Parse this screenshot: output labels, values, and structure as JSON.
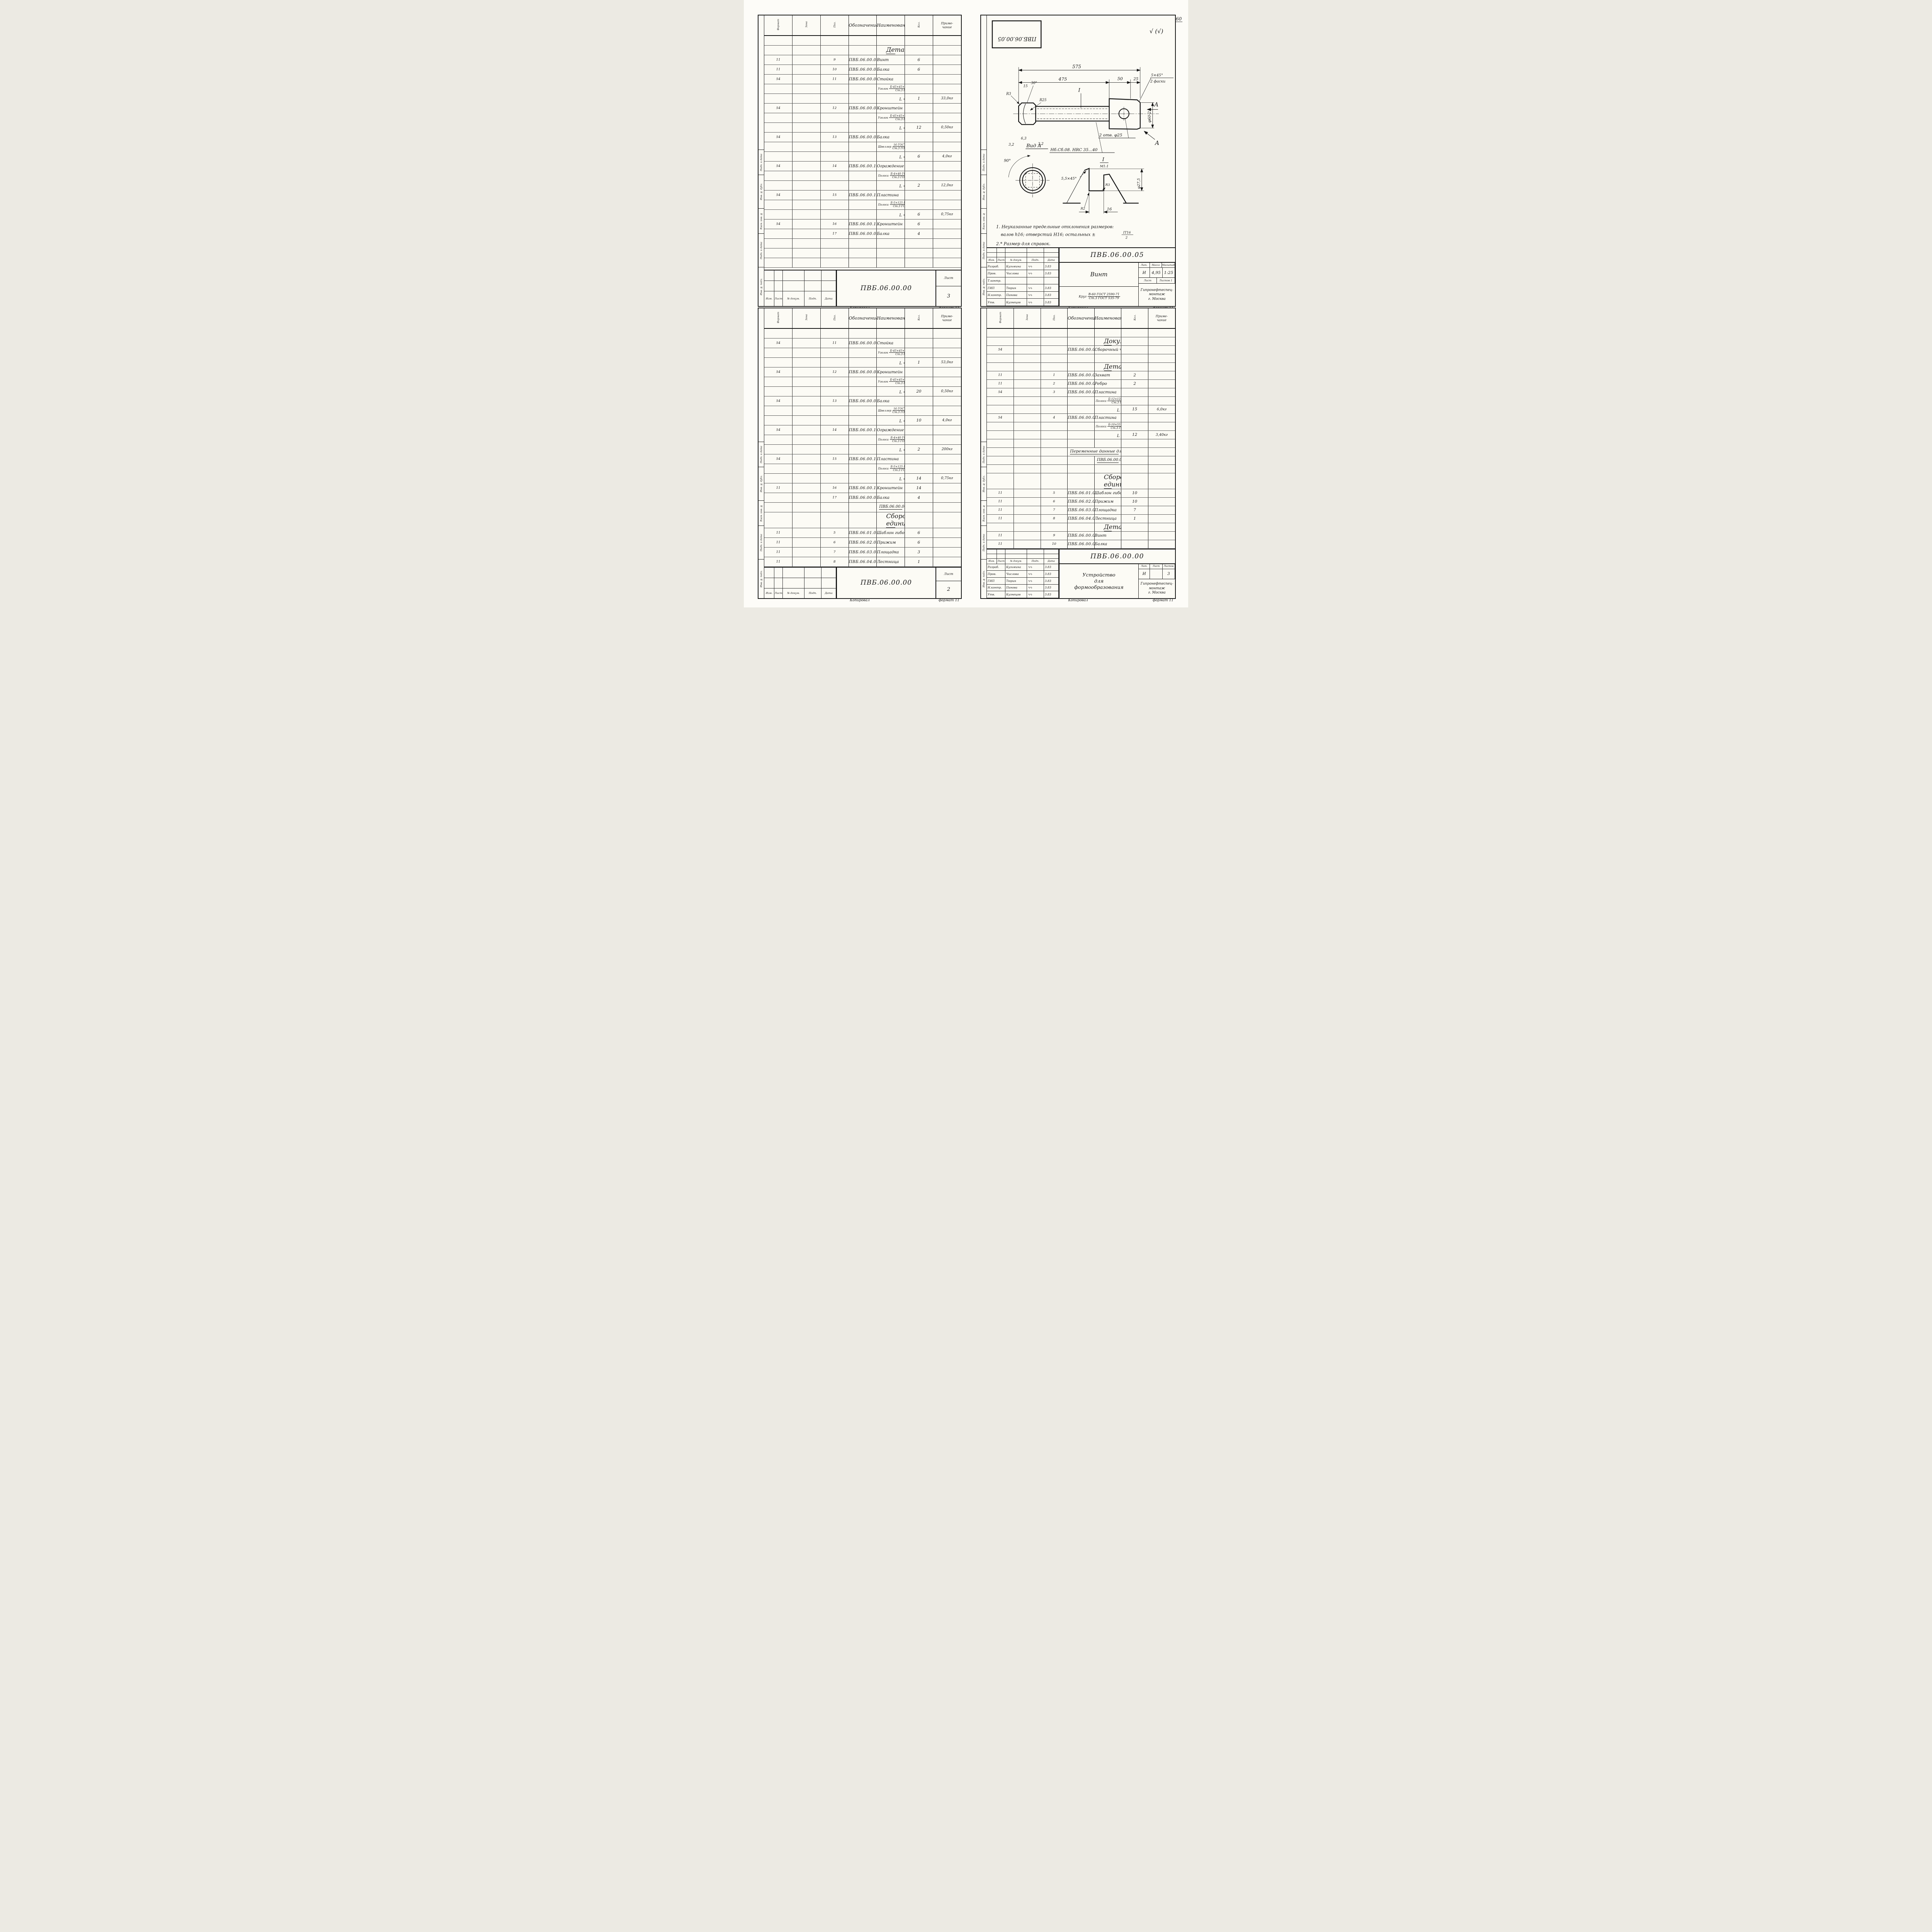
{
  "page": {
    "number": "60",
    "handwritten_margin_note": "т.пр 704-1-172.84 а.7",
    "copy_label": "Копировал",
    "format_label": "формат 11"
  },
  "spec_columns": {
    "format": "Формат",
    "zone": "Зона",
    "pos": "Поз.",
    "designation": "Обозначение",
    "name": "Наименование",
    "qty": "Кол.",
    "note1": "Приме-",
    "note2": "чание"
  },
  "margin_stamps": [
    "Подп. и дата",
    "Инв. № дубл.",
    "Взам. инв. №",
    "Подп. и дата",
    "Инв. № подл."
  ],
  "rev_labels": [
    "Изм.",
    "Лист",
    "№ докум.",
    "Подп.",
    "Дата"
  ],
  "org_lines": [
    "Гипронефтеспец-",
    "монтаж",
    "г. Москва"
  ],
  "signature_glyph": "∿∿",
  "tb_labels": {
    "lit": "Лит.",
    "mass": "Масса",
    "scale": "Масштаб",
    "sheet": "Лист",
    "sheets": "Листов"
  },
  "staff_spec": [
    {
      "role": "Разраб.",
      "name": "Кузьмина",
      "date": "3.83"
    },
    {
      "role": "Пров.",
      "name": "Числова",
      "date": "3.83"
    },
    {
      "role": "ГИП",
      "name": "Тюрин",
      "date": "3.83"
    },
    {
      "role": "Н.контр.",
      "name": "Панова",
      "date": "3.83"
    },
    {
      "role": "Утв.",
      "name": "Кузнецов",
      "date": "3.83"
    }
  ],
  "staff_drawing": [
    {
      "role": "Разраб.",
      "name": "Кузьмина",
      "date": "3.83"
    },
    {
      "role": "Пров.",
      "name": "Числова",
      "date": "3.83"
    },
    {
      "role": "Т.контр.",
      "name": "",
      "date": ""
    },
    {
      "role": "ГИП",
      "name": "Тюрин",
      "date": "3.83"
    },
    {
      "role": "Н.контр.",
      "name": "Панова",
      "date": "3.83"
    },
    {
      "role": "Утв.",
      "name": "Кузнецов",
      "date": "3.83"
    }
  ],
  "sheets": {
    "spec3": {
      "rows": [
        {
          "t": "b"
        },
        {
          "t": "s",
          "n": "Детали"
        },
        {
          "t": "i",
          "f": "11",
          "p": "9",
          "d": "ПВБ.06.00.05",
          "n": "Винт",
          "k": "6"
        },
        {
          "t": "i",
          "f": "11",
          "p": "10",
          "d": "ПВБ.06.00.06",
          "n": "Балка",
          "k": "6"
        },
        {
          "t": "i",
          "f": "54",
          "p": "11",
          "d": "ПВБ.06.00.07-01",
          "n": "Стойка"
        },
        {
          "t": "m",
          "a": "Уголок",
          "bb": "Б-45×45×5 ГОСТ 8509-72",
          "c": "Ст.3 ГОСТ 535-79"
        },
        {
          "t": "l",
          "n": "L = 9720",
          "k": "1",
          "m": "33,0кг"
        },
        {
          "t": "i",
          "f": "54",
          "p": "12",
          "d": "ПВБ.06.00.08",
          "n": "Кронштейн"
        },
        {
          "t": "m",
          "a": "Уголок",
          "bb": "Б-45×45×5 ГОСТ 8509-72",
          "c": "Ст.3 ГОСТ 535-79"
        },
        {
          "t": "l",
          "n": "L = 150",
          "k": "12",
          "m": "0,50кг"
        },
        {
          "t": "i",
          "f": "54",
          "p": "13",
          "d": "ПВБ.06.00.09",
          "n": "Балка"
        },
        {
          "t": "m",
          "a": "Швеллер",
          "bb": "16 ГОСТ 8240-72",
          "c": "Ст.3 ГОСТ 535-79"
        },
        {
          "t": "l",
          "n": "L = 280",
          "k": "6",
          "m": "4,0кг"
        },
        {
          "t": "i",
          "f": "54",
          "p": "14",
          "d": "ПВБ.06.00.10-01",
          "n": "Ограждение"
        },
        {
          "t": "m",
          "a": "Полоса",
          "bb": "Б-4×40 ГОСТ 103-76",
          "c": "Ст.3 ГОСТ 535-79"
        },
        {
          "t": "l",
          "n": "L = 9670",
          "k": "2",
          "m": "12,0кг"
        },
        {
          "t": "i",
          "f": "54",
          "p": "15",
          "d": "ПВБ.06.00.11",
          "n": "Пластина"
        },
        {
          "t": "m",
          "a": "Полоса",
          "bb": "Б-5×125 ГОСТ 103-76",
          "c": "Ст.3 ГОСТ 535-79"
        },
        {
          "t": "l",
          "n": "L = 150",
          "k": "6",
          "m": "0,75кг"
        },
        {
          "t": "i",
          "f": "54",
          "p": "16",
          "d": "ПВБ.06.00.12",
          "n": "Кронштейн",
          "k": "6"
        },
        {
          "t": "i",
          "f": "",
          "p": "17",
          "d": "ПВБ.06.00.06-01",
          "n": "Балка",
          "k": "4"
        },
        {
          "t": "b"
        },
        {
          "t": "b"
        },
        {
          "t": "b"
        }
      ],
      "footer": {
        "doc": "ПВБ.06.00.00",
        "sheet_label": "Лист",
        "sheet_no": "3"
      }
    },
    "spec2": {
      "rows": [
        {
          "t": "b"
        },
        {
          "t": "i",
          "f": "54",
          "p": "11",
          "d": "ПВБ.06.00.07",
          "n": "Стойка"
        },
        {
          "t": "m",
          "a": "Уголок",
          "bb": "Б-45×45×5 ГОСТ 8509-72",
          "c": "Ст.3 ГОСТ 535-79"
        },
        {
          "t": "l",
          "n": "L = 15120",
          "k": "1",
          "m": "53,0кг"
        },
        {
          "t": "i",
          "f": "54",
          "p": "12",
          "d": "ПВБ.06.00.08",
          "n": "Кронштейн"
        },
        {
          "t": "m",
          "a": "Уголок",
          "bb": "Б-45×45×5 ГОСТ 8509-72",
          "c": "Ст.3 ГОСТ 535-79"
        },
        {
          "t": "l",
          "n": "L = 150",
          "k": "20",
          "m": "0,50кг"
        },
        {
          "t": "i",
          "f": "54",
          "p": "13",
          "d": "ПВБ.06.00.09",
          "n": "Балка"
        },
        {
          "t": "m",
          "a": "Швеллер",
          "bb": "16 ГОСТ 8240-72",
          "c": "Ст.3 ГОСТ 535-79"
        },
        {
          "t": "l",
          "n": "L = 280",
          "k": "10",
          "m": "4,0кг"
        },
        {
          "t": "i",
          "f": "54",
          "p": "14",
          "d": "ПВБ.06.00.10",
          "n": "Ограждение"
        },
        {
          "t": "m",
          "a": "Полоса",
          "bb": "Б-4×40 ГОСТ 103-76",
          "c": "Ст.3 ГОСТ 535-79"
        },
        {
          "t": "l",
          "n": "L = 15670",
          "k": "2",
          "m": "200кг"
        },
        {
          "t": "i",
          "f": "54",
          "p": "15",
          "d": "ПВБ.06.00.11",
          "n": "Пластина"
        },
        {
          "t": "m",
          "a": "Полоса",
          "bb": "Б-5×125 ГОСТ 103-76",
          "c": "Ст.3 ГОСТ 535-79"
        },
        {
          "t": "l",
          "n": "L = 150",
          "k": "14",
          "m": "0,75кг"
        },
        {
          "t": "i",
          "f": "11",
          "p": "16",
          "d": "ПВБ.06.00.12",
          "n": "Кронштейн",
          "k": "14"
        },
        {
          "t": "i",
          "f": "",
          "p": "17",
          "d": "ПВБ.06.00.06-01",
          "n": "Балка",
          "k": "4"
        },
        {
          "t": "t1",
          "n": "ПВБ.06.00.00-01 см.Сб"
        },
        {
          "t": "s",
          "n": "Сборочные единицы"
        },
        {
          "t": "i",
          "f": "11",
          "p": "5",
          "d": "ПВБ.06.01.00",
          "n": "Шаблон гибочный",
          "k": "6"
        },
        {
          "t": "i",
          "f": "11",
          "p": "6",
          "d": "ПВБ.06.02.00",
          "n": "Прижим",
          "k": "6"
        },
        {
          "t": "i",
          "f": "11",
          "p": "7",
          "d": "ПВБ.06.03.00",
          "n": "Площадка",
          "k": "3"
        },
        {
          "t": "i",
          "f": "11",
          "p": "8",
          "d": "ПВБ.06.04.00-01",
          "n": "Лестница",
          "k": "1"
        }
      ],
      "footer": {
        "doc": "ПВБ.06.00.00",
        "sheet_label": "Лист",
        "sheet_no": "2"
      }
    },
    "spec1": {
      "rows": [
        {
          "t": "b"
        },
        {
          "t": "s",
          "n": "Документация"
        },
        {
          "t": "i",
          "f": "54",
          "p": "",
          "d": "ПВБ.06.00.00СБ",
          "n": "Сборочный чертеж"
        },
        {
          "t": "b"
        },
        {
          "t": "s",
          "n": "Детали"
        },
        {
          "t": "i",
          "f": "11",
          "p": "1",
          "d": "ПВБ.06.00.01",
          "n": "Захват",
          "k": "2"
        },
        {
          "t": "i",
          "f": "11",
          "p": "2",
          "d": "ПВБ.06.00.02",
          "n": "Ребро",
          "k": "2"
        },
        {
          "t": "i",
          "f": "54",
          "p": "3",
          "d": "ПВБ.06.00.03",
          "n": "Пластина"
        },
        {
          "t": "m",
          "a": "Полоса",
          "bb": "Б-12×125 ГОСТ 103-76",
          "c": "Ст.3 ГОСТ 535-79"
        },
        {
          "t": "l",
          "n": "L = 600",
          "k": "15",
          "m": "6,0кг"
        },
        {
          "t": "i",
          "f": "54",
          "p": "4",
          "d": "ПВБ.06.00.04",
          "n": "Пластина"
        },
        {
          "t": "m",
          "a": "Полоса",
          "bb": "Б-10×55 ГОСТ 103-76",
          "c": "Ст.3 ГОСТ 535-79"
        },
        {
          "t": "l",
          "n": "L = 450",
          "k": "12",
          "m": "3,40кг"
        },
        {
          "t": "b"
        },
        {
          "t": "t2",
          "n": "Переменные данные для исполнений"
        },
        {
          "t": "t1",
          "n": "ПВБ.06.00.00 см.Сб"
        },
        {
          "t": "b"
        },
        {
          "t": "s",
          "n": "Сборочные единицы"
        },
        {
          "t": "i",
          "f": "11",
          "p": "5",
          "d": "ПВБ.06.01.00",
          "n": "Шаблон гибочный",
          "k": "10"
        },
        {
          "t": "i",
          "f": "11",
          "p": "6",
          "d": "ПВБ.06.02.00",
          "n": "Прижим",
          "k": "10"
        },
        {
          "t": "i",
          "f": "11",
          "p": "7",
          "d": "ПВБ.06.03.00",
          "n": "Площадка",
          "k": "7"
        },
        {
          "t": "i",
          "f": "11",
          "p": "8",
          "d": "ПВБ.06.04.00",
          "n": "Лестница",
          "k": "1"
        },
        {
          "t": "s",
          "n": "Детали"
        },
        {
          "t": "i",
          "f": "11",
          "p": "9",
          "d": "ПВБ.06.00.05",
          "n": "Винт"
        },
        {
          "t": "i",
          "f": "11",
          "p": "10",
          "d": "ПВБ.06.00.06",
          "n": "Балка"
        }
      ],
      "title_block": {
        "doc": "ПВБ.06.00.00",
        "title_lines": [
          "Устройство",
          "для",
          "формообразования"
        ],
        "lit": "И",
        "sheet_no": "",
        "sheets_count": "3"
      }
    },
    "drawing": {
      "stamp": "ПВБ.06.00.05",
      "surface_mark": "√ (√)",
      "dims": {
        "overall": "575",
        "to_head": "475",
        "head": "50",
        "end": "25",
        "chamfer_top": "5×45°",
        "chamfer_bottom": "2 фаски",
        "r3": "R3",
        "a15": "15",
        "a30": "30°",
        "r25": "R25",
        "rough63": "6,3",
        "rough32a": "3,2",
        "rough32b": "3,2",
        "hrc_note": "Нб.Сб.08. HRC 35...40",
        "holes": "2 отв. φ25",
        "dia60": "φ60-2",
        "view_label": "Вид А",
        "angle90": "90°",
        "section": "I",
        "section_scale": "М1:1",
        "ch55": "5,5×45°",
        "dia275": "φ27,5",
        "r3b": "R3",
        "r2": "R2",
        "p16": "16",
        "a_top": "А",
        "a_bottom": "А"
      },
      "notes": {
        "n1a": "1. Неуказанные предельные отклонения размеров:",
        "n1b": "валов h16; отверстий Н16; остальных ±",
        "frac_top": "IT16",
        "frac_bot": "2",
        "n2": "2.* Размер для справок."
      },
      "title_block": {
        "doc": "ПВБ.06.00.05",
        "name": "Винт",
        "lit": "И",
        "mass": "4,95",
        "scale": "1:25",
        "sheet_no": "",
        "sheets_count": "1",
        "material": {
          "label": "Круг",
          "top": "В-60 ГОСТ 2590-71",
          "bot": "Ст.3 ГОСТ 535-79"
        }
      }
    }
  }
}
